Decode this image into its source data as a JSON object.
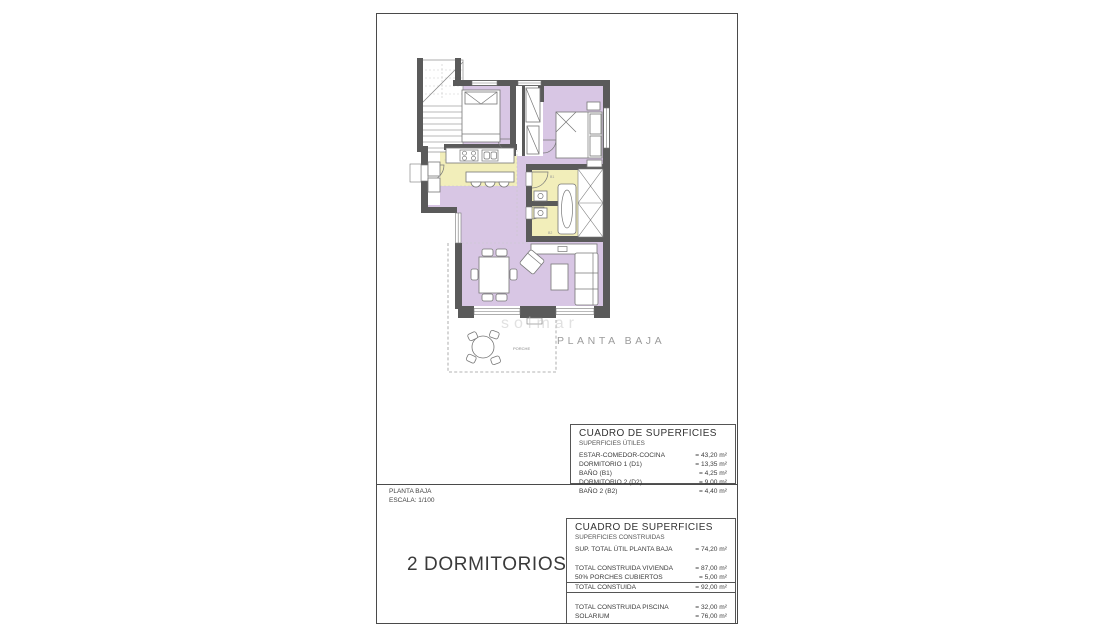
{
  "plan": {
    "caption": "PLANTA BAJA",
    "porch_label": "PORCHE",
    "watermark": "solmar",
    "room_codes": {
      "b1": "B1",
      "b2": "B2"
    }
  },
  "title_block": {
    "name": "PLANTA BAJA",
    "scale": "ESCALA: 1/100",
    "type": "2 DORMITORIOS"
  },
  "tables": {
    "utiles": {
      "title": "CUADRO DE SUPERFICIES",
      "subtitle": "SUPERFICIES ÚTILES",
      "rows": [
        {
          "label": "ESTAR-COMEDOR-COCINA",
          "value": "= 43,20 m²"
        },
        {
          "label": "DORMITORIO 1 (D1)",
          "value": "= 13,35 m²"
        },
        {
          "label": "BAÑO (B1)",
          "value": "= 4,25 m²"
        },
        {
          "label": "DORMITORIO 2 (D2)",
          "value": "= 9,00 m²"
        },
        {
          "label": "BAÑO 2 (B2)",
          "value": "= 4,40 m²"
        }
      ]
    },
    "construidas": {
      "title": "CUADRO DE SUPERFICIES",
      "subtitle": "SUPERFICIES CONSTRUIDAS",
      "rows": [
        {
          "label": "SUP. TOTAL ÚTIL PLANTA BAJA",
          "value": "= 74,20 m²"
        },
        {
          "label": "TOTAL CONSTRUIDA VIVIENDA",
          "value": "= 87,00 m²",
          "spacer_before": true
        },
        {
          "label": "50% PORCHES CUBIERTOS",
          "value": "= 5,00 m²"
        },
        {
          "label": "TOTAL CONSTUIDA",
          "value": "= 92,00 m²",
          "boxed": true
        },
        {
          "label": "TOTAL CONSTRUIDA PISCINA",
          "value": "= 32,00 m²",
          "spacer_before": true
        },
        {
          "label": "SOLARIUM",
          "value": "= 76,00 m²"
        }
      ]
    }
  },
  "colors": {
    "floor_main": "#d8c6e4",
    "floor_wet": "#f2eeba",
    "wall": "#5a5a5a"
  }
}
